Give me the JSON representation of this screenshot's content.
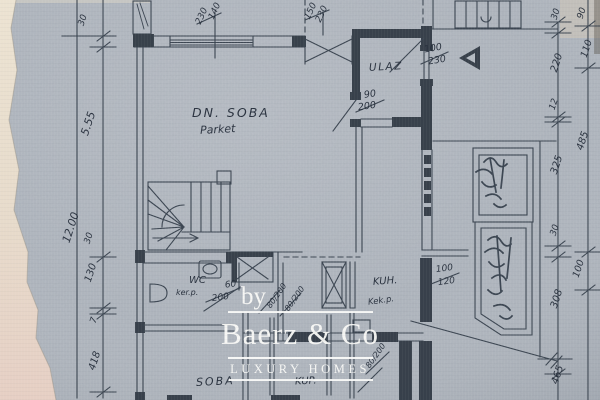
{
  "colors": {
    "paper": "#b2b8c0",
    "ink": "#2e3742",
    "torn_paper_top": "#ece3d2",
    "torn_paper_bottom": "#e6cfc4",
    "watermark": "#fbfbf8"
  },
  "watermark": {
    "by": "by",
    "brand": "Baerz & Co",
    "tagline": "LUXURY HOMES"
  },
  "rooms": {
    "dn_soba": "DN. SOBA",
    "dn_soba_floor": "Parket",
    "ulaz": "ULAZ",
    "wc": "WC",
    "wc_floor": "ker.p.",
    "kuh": "KUH.",
    "kuh_floor": "Kek.p.",
    "soba": "SOBA",
    "kup": "KUP."
  },
  "dims_left": {
    "a": "30",
    "b": "5.55",
    "c": "12.00",
    "d": "30",
    "e": "130",
    "f": "7",
    "g": "418"
  },
  "dims_right": {
    "a": "30",
    "b": "90",
    "c": "110",
    "d": "220",
    "e": "12",
    "f": "485",
    "g": "325",
    "h": "30",
    "i": "100",
    "j": "308",
    "k": "465"
  },
  "dims_top": {
    "win1_w": "230",
    "win1_h": "140",
    "win2_w": "150",
    "win2_h": "230"
  },
  "openings": {
    "entry_w": "100",
    "entry_h": "230",
    "hall_w": "90",
    "hall_h": "200",
    "wc_w": "60",
    "wc_h": "200",
    "win_right_w": "100",
    "win_right_h": "120",
    "door_a": "80/200",
    "door_b": "80/200",
    "door_c": "80/200"
  }
}
